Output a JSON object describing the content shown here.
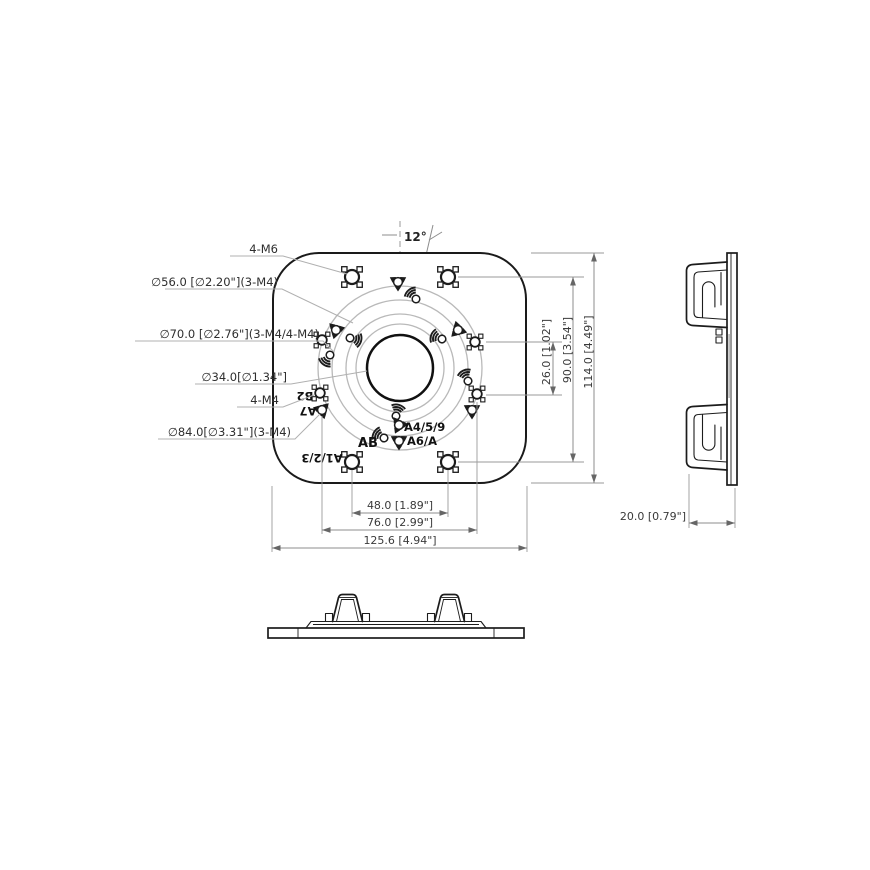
{
  "drawing_title": "mount-adapter-plate-technical-drawing",
  "front_view": {
    "angle_label": "12°",
    "callouts": [
      {
        "id": "m6",
        "text": "4-M6"
      },
      {
        "id": "d56",
        "text": "∅56.0 [∅2.20\"](3-M4)"
      },
      {
        "id": "d70",
        "text": "∅70.0 [∅2.76\"](3-M4/4-M4)"
      },
      {
        "id": "d34",
        "text": "∅34.0[∅1.34\"]"
      },
      {
        "id": "m4",
        "text": "4-M4"
      },
      {
        "id": "d84",
        "text": "∅84.0[∅3.31\"](3-M4)"
      }
    ],
    "plate_labels": {
      "b2": "B2",
      "a7": "A7",
      "ab": "AB",
      "a459": "A4/5/9",
      "a6a": "A6/A",
      "a123": "A1/2/3"
    },
    "dims_horizontal": [
      {
        "id": "dim48",
        "text": "48.0 [1.89\"]"
      },
      {
        "id": "dim76",
        "text": "76.0 [2.99\"]"
      },
      {
        "id": "dim125",
        "text": "125.6 [4.94\"]"
      }
    ],
    "dims_vertical": [
      {
        "id": "dim26",
        "text": "26.0 [1.02\"]"
      },
      {
        "id": "dim90",
        "text": "90.0 [3.54\"]"
      },
      {
        "id": "dim114",
        "text": "114.0 [4.49\"]"
      }
    ]
  },
  "side_view": {
    "thickness_dim": "20.0 [0.79\"]"
  },
  "colors": {
    "line": "#1c1c1c",
    "dim_line": "#8c8c8c",
    "bolt_circle": "#b9b9b9",
    "background": "#ffffff"
  }
}
